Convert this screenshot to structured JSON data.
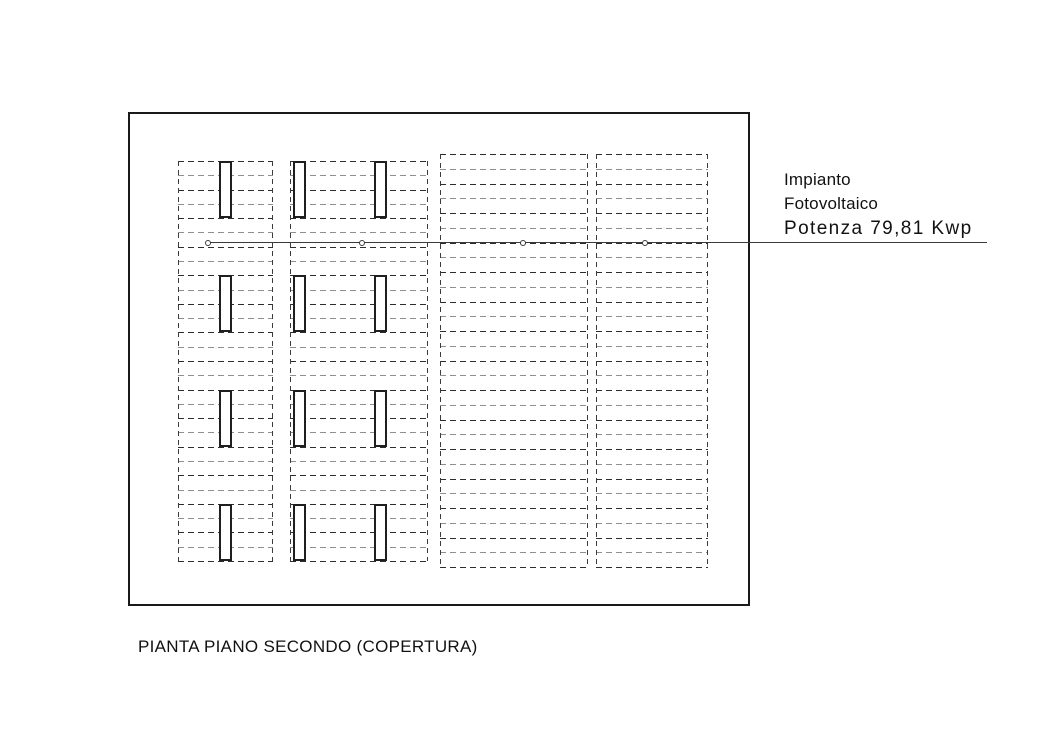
{
  "annotation": {
    "line1": "Impianto",
    "line2": "Fotovoltaico",
    "line3": "Potenza 79,81 Kwp"
  },
  "caption": "PIANTA PIANO SECONDO (COPERTURA)",
  "colors": {
    "border": "#1a1a1a",
    "row_dark": "#2d2d2d",
    "row_gray": "#8f8f8f",
    "edge": "#3c3c3c",
    "leader": "#3a3a3a",
    "rect_border": "#1f1f1f",
    "rect_fill": "#ffffff"
  },
  "drawing": {
    "plan_border": {
      "x": 128,
      "y": 112,
      "w": 622,
      "h": 494
    },
    "panel_blocks": [
      {
        "x": 178,
        "y": 161,
        "w": 95,
        "h": 400,
        "rows": 28
      },
      {
        "x": 290,
        "y": 161,
        "w": 138,
        "h": 400,
        "rows": 28
      },
      {
        "x": 440,
        "y": 154,
        "w": 148,
        "h": 413,
        "rows": 28
      },
      {
        "x": 596,
        "y": 154,
        "w": 112,
        "h": 413,
        "rows": 28
      }
    ],
    "structure_rects": [
      {
        "x": 219,
        "y": 161,
        "w": 13,
        "h": 57
      },
      {
        "x": 219,
        "y": 275,
        "w": 13,
        "h": 57
      },
      {
        "x": 219,
        "y": 390,
        "w": 13,
        "h": 57
      },
      {
        "x": 219,
        "y": 504,
        "w": 13,
        "h": 57
      },
      {
        "x": 293,
        "y": 161,
        "w": 13,
        "h": 57
      },
      {
        "x": 293,
        "y": 275,
        "w": 13,
        "h": 57
      },
      {
        "x": 293,
        "y": 390,
        "w": 13,
        "h": 57
      },
      {
        "x": 293,
        "y": 504,
        "w": 13,
        "h": 57
      },
      {
        "x": 374,
        "y": 161,
        "w": 13,
        "h": 57
      },
      {
        "x": 374,
        "y": 275,
        "w": 13,
        "h": 57
      },
      {
        "x": 374,
        "y": 390,
        "w": 13,
        "h": 57
      },
      {
        "x": 374,
        "y": 504,
        "w": 13,
        "h": 57
      }
    ],
    "leader": {
      "x1": 208,
      "x2": 987,
      "y": 242
    },
    "leader_circles": [
      {
        "cx": 208,
        "cy": 243
      },
      {
        "cx": 362,
        "cy": 243
      },
      {
        "cx": 523,
        "cy": 243
      },
      {
        "cx": 645,
        "cy": 243
      }
    ]
  }
}
